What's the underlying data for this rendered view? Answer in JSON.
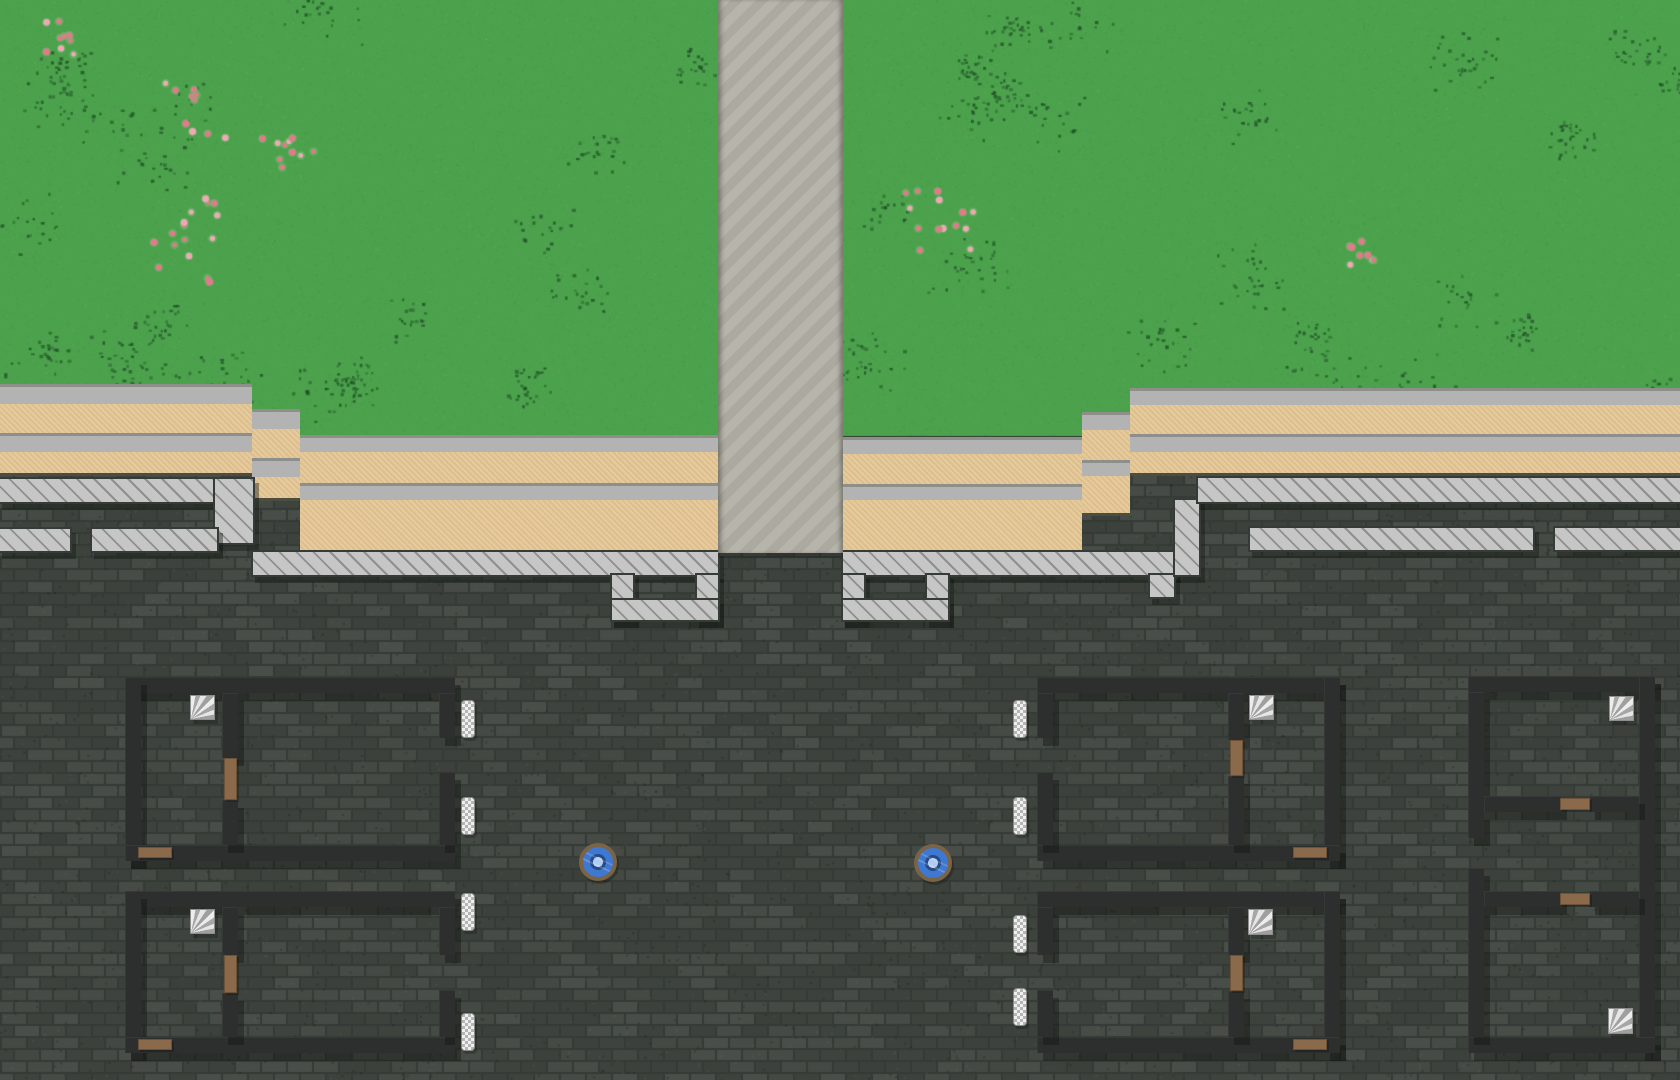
{
  "scene": {
    "width": 1680,
    "height": 1080,
    "label": "top-down village map with plaza, road and buildings"
  },
  "palette": {
    "grass_base": "#4CA24C",
    "grass_dot": "#2b6134",
    "flower": "#e07a8c",
    "flower_light": "#efa8b5",
    "road": "#b2b0a6",
    "gray_band": "#b3b3b3",
    "band_edge": "#8e8e8a",
    "sand": "#e3c594",
    "plaza_base": "#40463f",
    "plaza_mortar": "#343a35",
    "hatch": "#c6c6c6",
    "hatch_line": "#8f8f8d",
    "wall": "#2d2f2e",
    "door": "#8b6a4b",
    "stairs_light": "#ededed",
    "stairs_dark": "#a0a0a0",
    "window_light": "#f0f0f0",
    "window_dark": "#b5b5b5",
    "well_ring": "#7b6345",
    "well_water": "#3e78d1",
    "well_hub": "#aecdf0",
    "well_hub_ring": "#274a86"
  },
  "grass": {
    "rect": [
      0,
      0,
      1680,
      436
    ],
    "speckle_seed": 7,
    "speckle_patches": 46,
    "flower_clusters": [
      {
        "x": 62,
        "y": 33,
        "r": 24,
        "n": 9
      },
      {
        "x": 190,
        "y": 110,
        "r": 40,
        "n": 10
      },
      {
        "x": 285,
        "y": 143,
        "r": 30,
        "n": 10
      },
      {
        "x": 195,
        "y": 245,
        "r": 55,
        "n": 16
      },
      {
        "x": 938,
        "y": 218,
        "r": 38,
        "n": 14
      },
      {
        "x": 1368,
        "y": 248,
        "r": 24,
        "n": 8
      }
    ]
  },
  "plaza": {
    "rect": [
      0,
      436,
      1680,
      644
    ]
  },
  "road": {
    "rect": [
      718,
      0,
      125,
      553
    ]
  },
  "terrain_bands": [
    {
      "type": "gray",
      "rect": [
        0,
        384,
        252,
        20
      ]
    },
    {
      "type": "sand",
      "rect": [
        0,
        404,
        252,
        29
      ]
    },
    {
      "type": "gray",
      "rect": [
        0,
        433,
        252,
        19
      ]
    },
    {
      "type": "sand",
      "rect": [
        0,
        452,
        252,
        24
      ],
      "edge": true
    },
    {
      "type": "gray",
      "rect": [
        252,
        409,
        48,
        20
      ]
    },
    {
      "type": "sand",
      "rect": [
        252,
        429,
        48,
        29
      ]
    },
    {
      "type": "gray",
      "rect": [
        252,
        458,
        48,
        19
      ]
    },
    {
      "type": "sand",
      "rect": [
        252,
        477,
        48,
        24
      ],
      "edge": true
    },
    {
      "type": "gray",
      "rect": [
        300,
        435,
        418,
        17
      ]
    },
    {
      "type": "sand",
      "rect": [
        300,
        452,
        418,
        31
      ]
    },
    {
      "type": "gray",
      "rect": [
        300,
        483,
        418,
        17
      ]
    },
    {
      "type": "sand",
      "rect": [
        300,
        500,
        418,
        53
      ],
      "edge": true
    },
    {
      "type": "gray",
      "rect": [
        843,
        437,
        239,
        17
      ]
    },
    {
      "type": "sand",
      "rect": [
        843,
        454,
        239,
        30
      ]
    },
    {
      "type": "gray",
      "rect": [
        843,
        484,
        239,
        16
      ]
    },
    {
      "type": "sand",
      "rect": [
        843,
        500,
        239,
        53
      ],
      "edge": true
    },
    {
      "type": "gray",
      "rect": [
        1082,
        412,
        48,
        18
      ]
    },
    {
      "type": "sand",
      "rect": [
        1082,
        430,
        48,
        30
      ]
    },
    {
      "type": "gray",
      "rect": [
        1082,
        460,
        48,
        16
      ]
    },
    {
      "type": "sand",
      "rect": [
        1082,
        476,
        48,
        40
      ],
      "edge": true
    },
    {
      "type": "gray",
      "rect": [
        1130,
        388,
        550,
        17
      ]
    },
    {
      "type": "sand",
      "rect": [
        1130,
        405,
        550,
        29
      ]
    },
    {
      "type": "gray",
      "rect": [
        1130,
        434,
        550,
        18
      ]
    },
    {
      "type": "sand",
      "rect": [
        1130,
        452,
        550,
        24
      ],
      "edge": true
    }
  ],
  "hatch_segments": [
    {
      "rect": [
        0,
        479,
        215,
        23
      ]
    },
    {
      "rect": [
        215,
        479,
        38,
        64
      ]
    },
    {
      "rect": [
        0,
        529,
        70,
        22
      ]
    },
    {
      "rect": [
        92,
        529,
        125,
        22
      ]
    },
    {
      "rect": [
        253,
        552,
        465,
        23
      ]
    },
    {
      "rect": [
        612,
        575,
        21,
        45
      ]
    },
    {
      "rect": [
        697,
        575,
        21,
        45
      ]
    },
    {
      "rect": [
        612,
        600,
        106,
        20
      ]
    },
    {
      "rect": [
        843,
        552,
        332,
        23
      ]
    },
    {
      "rect": [
        843,
        575,
        21,
        45
      ]
    },
    {
      "rect": [
        927,
        575,
        21,
        45
      ]
    },
    {
      "rect": [
        843,
        600,
        105,
        20
      ]
    },
    {
      "rect": [
        1150,
        575,
        24,
        22
      ]
    },
    {
      "rect": [
        1175,
        500,
        24,
        75
      ]
    },
    {
      "rect": [
        1198,
        478,
        482,
        24
      ]
    },
    {
      "rect": [
        1250,
        528,
        283,
        22
      ]
    },
    {
      "rect": [
        1555,
        528,
        125,
        22
      ]
    }
  ],
  "buildings": [
    {
      "id": "house-nw",
      "walls": [
        [
          125,
          677,
          330,
          16
        ],
        [
          125,
          677,
          16,
          184
        ],
        [
          125,
          845,
          330,
          16
        ],
        [
          439,
          693,
          16,
          45
        ],
        [
          439,
          772,
          16,
          73
        ],
        [
          222,
          693,
          16,
          65
        ],
        [
          222,
          800,
          16,
          45
        ]
      ],
      "doors": [
        {
          "orientation": "v",
          "rect": [
            224,
            758,
            13,
            42
          ]
        },
        {
          "orientation": "h",
          "rect": [
            138,
            847,
            34,
            11
          ]
        }
      ],
      "stairs": [
        [
          190,
          695,
          25,
          25
        ]
      ],
      "windows": [
        [
          461,
          700,
          14,
          38
        ],
        [
          461,
          797,
          14,
          38
        ]
      ]
    },
    {
      "id": "house-sw",
      "walls": [
        [
          125,
          891,
          330,
          16
        ],
        [
          125,
          891,
          16,
          162
        ],
        [
          125,
          1037,
          330,
          16
        ],
        [
          439,
          907,
          16,
          48
        ],
        [
          439,
          990,
          16,
          47
        ],
        [
          222,
          907,
          16,
          48
        ],
        [
          222,
          993,
          16,
          44
        ]
      ],
      "doors": [
        {
          "orientation": "v",
          "rect": [
            224,
            955,
            13,
            38
          ]
        },
        {
          "orientation": "h",
          "rect": [
            138,
            1039,
            34,
            11
          ]
        }
      ],
      "stairs": [
        [
          190,
          909,
          25,
          25
        ]
      ],
      "windows": [
        [
          461,
          893,
          14,
          38
        ],
        [
          461,
          1013,
          14,
          38
        ]
      ]
    },
    {
      "id": "house-ne",
      "walls": [
        [
          1037,
          677,
          303,
          16
        ],
        [
          1324,
          677,
          16,
          184
        ],
        [
          1037,
          845,
          303,
          16
        ],
        [
          1037,
          693,
          16,
          45
        ],
        [
          1037,
          772,
          16,
          73
        ],
        [
          1228,
          693,
          16,
          47
        ],
        [
          1228,
          776,
          16,
          69
        ]
      ],
      "doors": [
        {
          "orientation": "v",
          "rect": [
            1230,
            740,
            13,
            36
          ]
        },
        {
          "orientation": "h",
          "rect": [
            1293,
            847,
            34,
            11
          ]
        }
      ],
      "stairs": [
        [
          1249,
          695,
          25,
          25
        ]
      ],
      "windows": [
        [
          1013,
          700,
          14,
          38
        ],
        [
          1013,
          797,
          14,
          38
        ]
      ]
    },
    {
      "id": "house-se",
      "walls": [
        [
          1037,
          891,
          303,
          16
        ],
        [
          1324,
          891,
          16,
          162
        ],
        [
          1037,
          1037,
          303,
          16
        ],
        [
          1037,
          907,
          16,
          48
        ],
        [
          1037,
          990,
          16,
          47
        ],
        [
          1228,
          907,
          16,
          48
        ],
        [
          1228,
          991,
          16,
          46
        ]
      ],
      "doors": [
        {
          "orientation": "v",
          "rect": [
            1230,
            955,
            13,
            36
          ]
        },
        {
          "orientation": "h",
          "rect": [
            1293,
            1039,
            34,
            11
          ]
        }
      ],
      "stairs": [
        [
          1248,
          909,
          25,
          26
        ]
      ],
      "windows": [
        [
          1013,
          915,
          14,
          38
        ],
        [
          1013,
          988,
          14,
          38
        ]
      ]
    },
    {
      "id": "rowhouse-east",
      "walls": [
        [
          1468,
          676,
          187,
          16
        ],
        [
          1639,
          676,
          16,
          377
        ],
        [
          1468,
          1037,
          187,
          16
        ],
        [
          1468,
          692,
          16,
          146
        ],
        [
          1468,
          868,
          16,
          169
        ],
        [
          1484,
          796,
          77,
          16
        ],
        [
          1589,
          796,
          50,
          16
        ],
        [
          1484,
          891,
          77,
          16
        ],
        [
          1589,
          891,
          50,
          16
        ]
      ],
      "doors": [
        {
          "orientation": "h",
          "rect": [
            1560,
            798,
            30,
            12
          ]
        },
        {
          "orientation": "h",
          "rect": [
            1560,
            893,
            30,
            12
          ]
        }
      ],
      "stairs": [
        [
          1609,
          696,
          25,
          25
        ],
        [
          1608,
          1008,
          25,
          26
        ]
      ],
      "windows": []
    }
  ],
  "wells": [
    {
      "rect": [
        579,
        843,
        38,
        38
      ]
    },
    {
      "rect": [
        914,
        844,
        38,
        38
      ]
    }
  ]
}
